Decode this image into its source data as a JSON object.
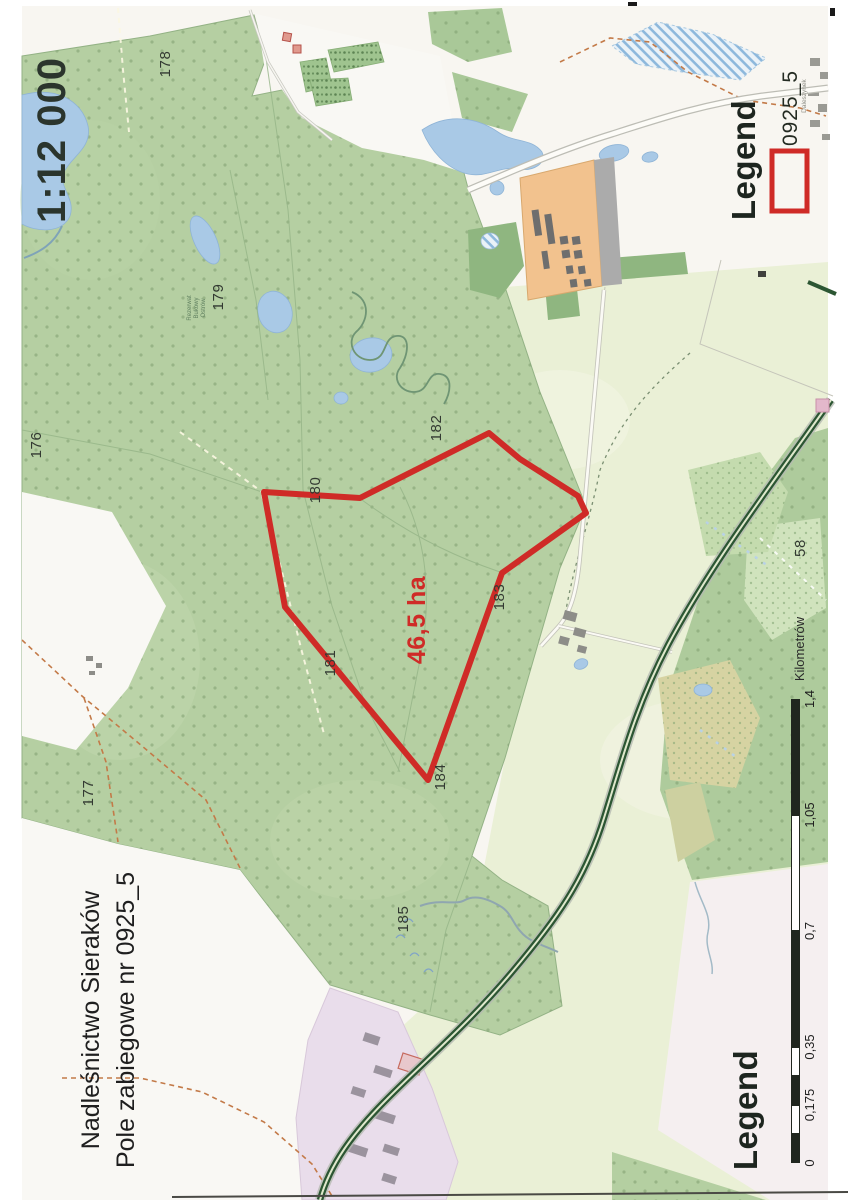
{
  "document": {
    "scale_text": "1:12 000",
    "title_line1": "Nadleśnictwo Sieraków",
    "title_line2": "Pole zabiegowe nr 0925_5"
  },
  "legend_top": {
    "title": "Legend",
    "item_label": "0925_5"
  },
  "legend_bottom": {
    "title": "Legend"
  },
  "highlight": {
    "area_label": "46,5 ha",
    "color": "#cf2b27"
  },
  "map_labels": {
    "compartments": [
      {
        "text": "176",
        "x": 36,
        "y": 445
      },
      {
        "text": "177",
        "x": 88,
        "y": 793
      },
      {
        "text": "178",
        "x": 165,
        "y": 64
      },
      {
        "text": "179",
        "x": 218,
        "y": 297
      },
      {
        "text": "180",
        "x": 315,
        "y": 490
      },
      {
        "text": "181",
        "x": 330,
        "y": 663
      },
      {
        "text": "182",
        "x": 436,
        "y": 428
      },
      {
        "text": "183",
        "x": 499,
        "y": 597
      },
      {
        "text": "184",
        "x": 440,
        "y": 777
      },
      {
        "text": "185",
        "x": 403,
        "y": 919
      },
      {
        "text": "58",
        "x": 800,
        "y": 548
      }
    ],
    "tiny_labels": [
      {
        "text": "Daleszynek",
        "x": 804,
        "y": 96,
        "size": 6.5,
        "color": "#8d8d85"
      },
      {
        "text": "Rezerwat",
        "x": 190,
        "y": 308,
        "size": 6,
        "color": "#5f7f5f"
      },
      {
        "text": "Bukowy",
        "x": 197,
        "y": 308,
        "size": 6,
        "color": "#5f7f5f"
      },
      {
        "text": "Ostrów",
        "x": 204,
        "y": 308,
        "size": 6,
        "color": "#5f7f5f"
      }
    ]
  },
  "scalebar": {
    "unit_label": "Kilometrów",
    "ticks": [
      {
        "label": "0",
        "km": 0
      },
      {
        "label": "0,175",
        "km": 0.175
      },
      {
        "label": "0,35",
        "km": 0.35
      },
      {
        "label": "0,7",
        "km": 0.7
      },
      {
        "label": "1,05",
        "km": 1.05
      },
      {
        "label": "1,4",
        "km": 1.4
      }
    ],
    "segments": [
      {
        "from": 0,
        "to": 0.0875,
        "style": "dark"
      },
      {
        "from": 0.0875,
        "to": 0.175,
        "style": "light"
      },
      {
        "from": 0.175,
        "to": 0.2625,
        "style": "dark"
      },
      {
        "from": 0.2625,
        "to": 0.35,
        "style": "light"
      },
      {
        "from": 0.35,
        "to": 0.7,
        "style": "dark"
      },
      {
        "from": 0.7,
        "to": 1.05,
        "style": "light"
      },
      {
        "from": 1.05,
        "to": 1.4,
        "style": "dark"
      }
    ],
    "geometry": {
      "x": 791,
      "width": 9,
      "y_zero": 1163,
      "y_max": 699
    }
  },
  "colors": {
    "forest_green": "#b5cfa2",
    "field_green": "#eaf0d6",
    "water_blue": "#a9c9e6",
    "built_orange": "#f2c28e",
    "urban_pink": "#e9ddeb",
    "tree_road_green": "#2c5633",
    "highlight_red": "#cf2b27",
    "scalebar_dark": "#20261f"
  }
}
